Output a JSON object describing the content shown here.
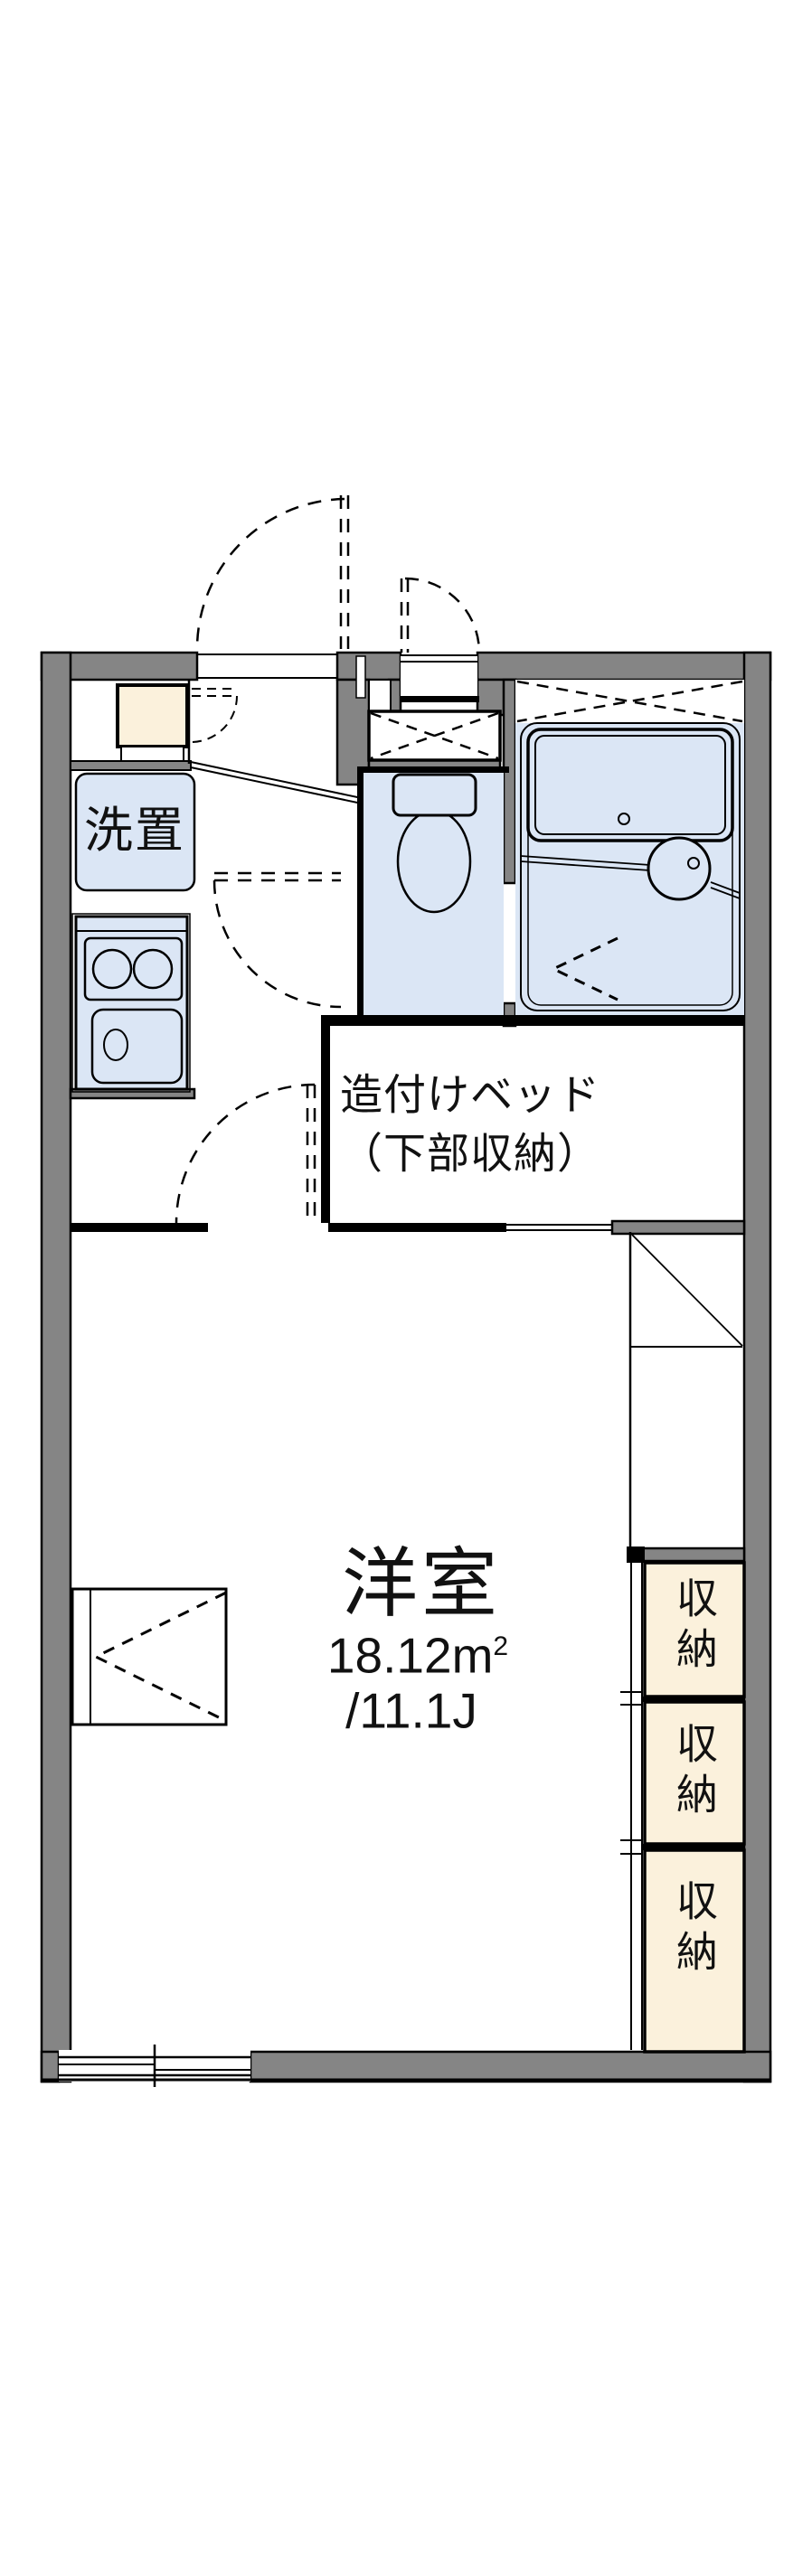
{
  "floorplan": {
    "labels": {
      "laundry": "洗置",
      "bed_line1": "造付けベッド",
      "bed_line2": "（下部収納）",
      "room_name": "洋室",
      "room_area": "18.12m",
      "room_area_sup": "2",
      "room_size": "/11.1J",
      "storage_1": "収納",
      "storage_2": "収納",
      "storage_3": "収納"
    },
    "colors": {
      "wall_gray": "#858585",
      "wet_area_blue": "#dbe6f5",
      "storage_cream": "#fbf1dc",
      "line_black": "#000000",
      "background": "#ffffff"
    }
  }
}
